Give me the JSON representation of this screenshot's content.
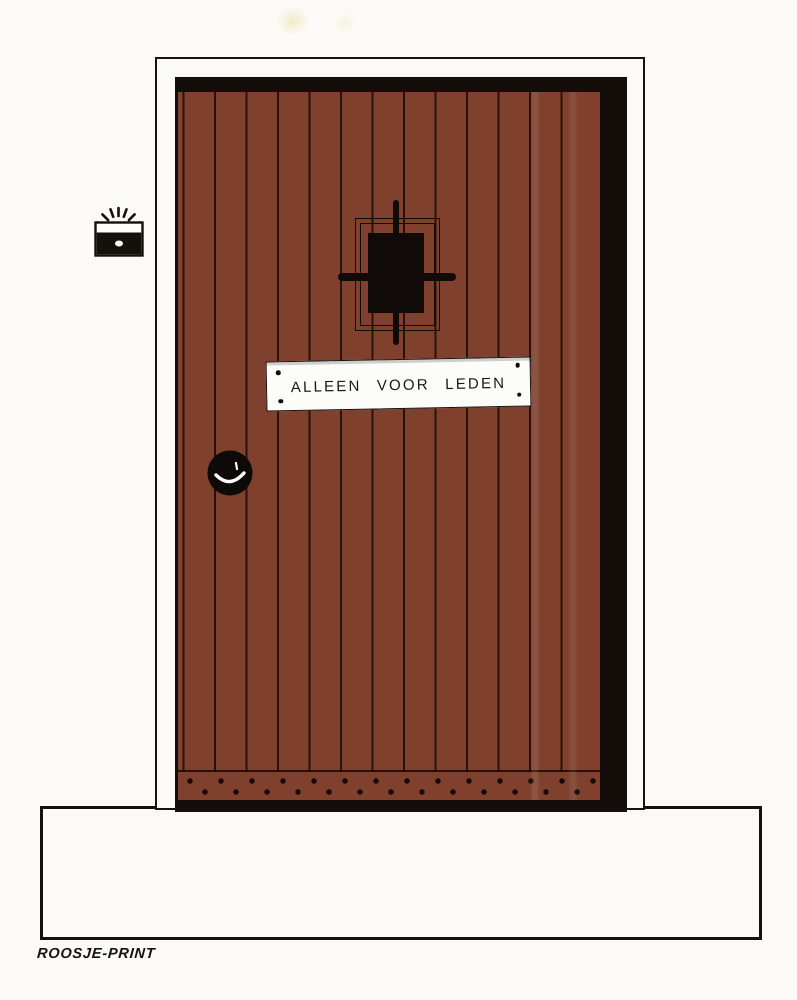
{
  "sign": {
    "label": "ALLEEN VOOR LEDEN"
  },
  "footer": {
    "event": "Een avond over homobars",
    "date": "Zaterdag 7 maart",
    "org": "COC–Nijmegen",
    "venue": "O 42",
    "time": "9 uur–3 uur"
  },
  "credit": {
    "printer": "ROOSJE-PRINT"
  },
  "colors": {
    "paper": "#fbfaf6",
    "ink": "#17120e",
    "door_brown": "#7f402e",
    "door_dark": "#140d09",
    "sign_white": "#fcfcf9"
  }
}
